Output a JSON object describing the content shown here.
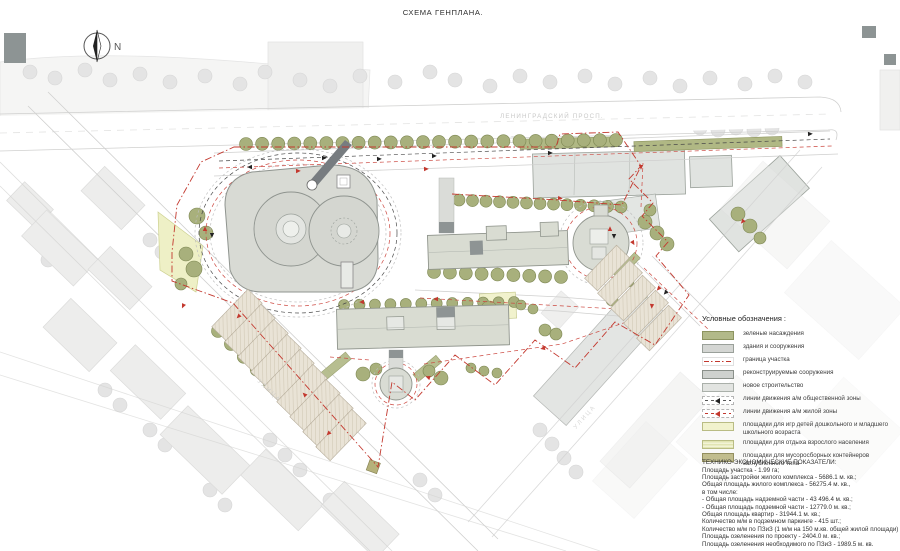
{
  "title": "СХЕМА ГЕНПЛАНА.",
  "north_label": "N",
  "streets": {
    "top": "ЛЕНИНГРАДСКИЙ ПРОСП.",
    "left": "УЛИЦА",
    "right": "УЛИЦА"
  },
  "legend": {
    "title": "Условные обозначения :",
    "items": [
      {
        "type": "green",
        "label": "зеленые насаждения"
      },
      {
        "type": "gray",
        "label": "здания и сооружения"
      },
      {
        "type": "bound",
        "label": "граница участка"
      },
      {
        "type": "recon",
        "label": "реконструируемые сооружения"
      },
      {
        "type": "new",
        "label": "новое строительство"
      },
      {
        "type": "traffic-black",
        "label": "линии движения а/м общественной зоны"
      },
      {
        "type": "traffic-red",
        "label": "линии движения а/м жилой зоны"
      },
      {
        "type": "playground",
        "label": "площадки для игр детей дошкольного и младшего школьного возраста"
      },
      {
        "type": "rest",
        "label": "площадки для отдыха взрослого населения"
      },
      {
        "type": "waste",
        "label": "площадки для мусоросборных контейнеров заглубленного типа"
      }
    ]
  },
  "indicators": {
    "title": "ТЕХНИКО-ЭКОНОМИЧЕСКИЕ ПОКАЗАТЕЛИ:",
    "lines": [
      "Площадь участка - 1.99 га;",
      "Площадь застройки жилого комплекса - 5686.1 м. кв.;",
      "Общая площадь жилого комплекса - 56275.4 м. кв.,",
      "в том числе:",
      "- Общая площадь надземной части - 43 496.4 м. кв.;",
      "- Общая площадь подземной части - 12779.0 м. кв.;",
      "Общая площадь квартир - 31944.1 м. кв.;",
      "Количество м/м в подземном паркинге - 415 шт.;",
      "Количество м/м по ПЗиЗ (1 м/м на 150 м.кв. общей жилой площади) - 213 шт.;",
      "Площадь озеленения по проекту - 2404.0 м. кв.;",
      "Площадь озеленения необходимого по ПЗиЗ - 1989.5 м. кв."
    ]
  },
  "colors": {
    "green": "#a8b07c",
    "building": "#d7dad3",
    "boundary_red": "#c3382e",
    "playground_yellow": "#f1f2cd",
    "waste_olive": "#c1bd8e"
  }
}
